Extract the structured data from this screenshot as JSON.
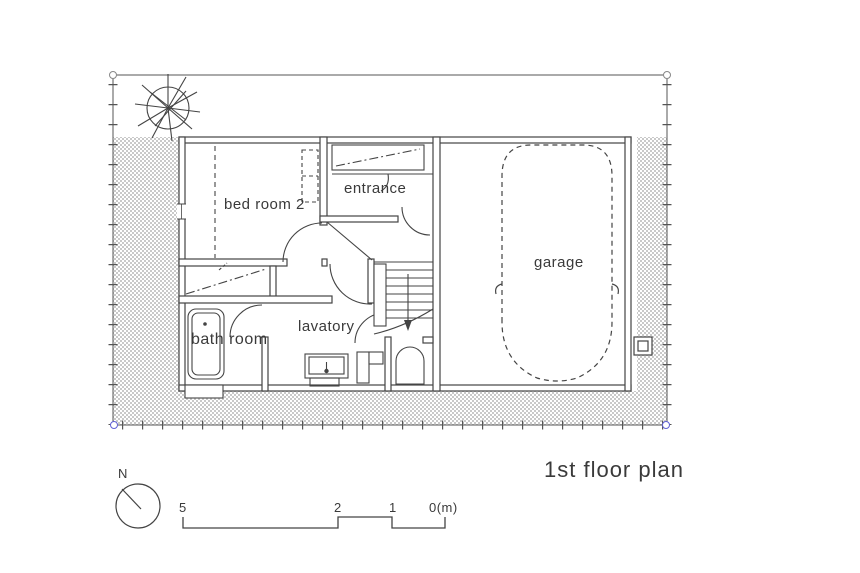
{
  "title": {
    "text": "1st floor plan"
  },
  "rooms": [
    {
      "id": "bed-room-2",
      "label": "bed room 2"
    },
    {
      "id": "entrance",
      "label": "entrance"
    },
    {
      "id": "garage",
      "label": "garage"
    },
    {
      "id": "lavatory",
      "label": "lavatory"
    },
    {
      "id": "bath-room",
      "label": "bath room"
    }
  ],
  "compass": {
    "label": "N"
  },
  "scale_bar": {
    "marks": [
      "5",
      "2",
      "1",
      "0(m)"
    ]
  },
  "symbols": {
    "tree": "deciduous-tree-icon",
    "car": "car-dashed-outline-icon",
    "stairs": "staircase-with-down-arrow",
    "bathtub": "bathtub-icon",
    "toilet": "toilet-icon",
    "sink": "vanity-sink-icon",
    "meter": "meter-box-icon",
    "north": "north-arrow-icon"
  },
  "colors": {
    "line": "#444444",
    "text": "#3a3a3a",
    "hatch": "#c9c9c9",
    "corner_marker_top": "#888888",
    "corner_marker_bottom": "#6161d6",
    "background": "#ffffff"
  }
}
